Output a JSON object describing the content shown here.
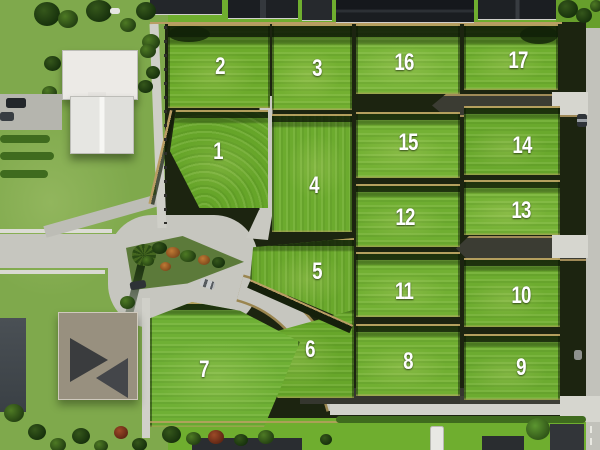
{
  "alt": "Aerial drone photo of a 17-lot grassed residential subdivision with a cul-de-sac, shared driveways and surrounding houses",
  "palette": {
    "grass": "#6fae2f",
    "grassDull": "#7fa94c",
    "grassBerm": "#5a9226",
    "road": "#c6c6bf",
    "roadLight": "#d6d6cf",
    "asphalt": "#3b3c33",
    "fence": "#b99d64",
    "shadow": "#15200b",
    "roofDark": "#1b1d21",
    "roofWhite": "#eceae6",
    "roofTaupe": "#98907f",
    "treeGreen": "#4e7a24",
    "treeDark": "#244112",
    "label": "#ffffff"
  },
  "lots": [
    {
      "label": "1",
      "x": 218,
      "y": 152
    },
    {
      "label": "2",
      "x": 220,
      "y": 67
    },
    {
      "label": "3",
      "x": 317,
      "y": 69
    },
    {
      "label": "4",
      "x": 314,
      "y": 186
    },
    {
      "label": "5",
      "x": 317,
      "y": 272
    },
    {
      "label": "6",
      "x": 310,
      "y": 350
    },
    {
      "label": "7",
      "x": 204,
      "y": 370
    },
    {
      "label": "8",
      "x": 408,
      "y": 362
    },
    {
      "label": "9",
      "x": 521,
      "y": 368
    },
    {
      "label": "10",
      "x": 521,
      "y": 296
    },
    {
      "label": "11",
      "x": 404,
      "y": 292
    },
    {
      "label": "12",
      "x": 405,
      "y": 218
    },
    {
      "label": "13",
      "x": 521,
      "y": 211
    },
    {
      "label": "14",
      "x": 522,
      "y": 146
    },
    {
      "label": "15",
      "x": 408,
      "y": 143
    },
    {
      "label": "16",
      "x": 404,
      "y": 63
    },
    {
      "label": "17",
      "x": 518,
      "y": 61
    }
  ]
}
